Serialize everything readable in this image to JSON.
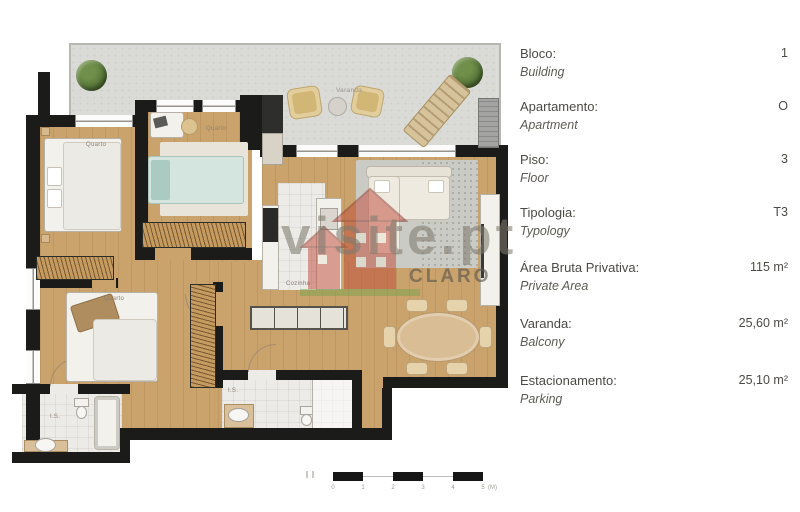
{
  "info_panel": {
    "rows": [
      {
        "label_pt": "Bloco:",
        "label_en": "Building",
        "value": "1"
      },
      {
        "label_pt": "Apartamento:",
        "label_en": "Apartment",
        "value": "O"
      },
      {
        "label_pt": "Piso:",
        "label_en": "Floor",
        "value": "3"
      },
      {
        "label_pt": "Tipologia:",
        "label_en": "Typology",
        "value": "T3"
      },
      {
        "label_pt": "Área Bruta Privativa:",
        "label_en": "Private Area",
        "value": "115 m²"
      },
      {
        "label_pt": "Varanda:",
        "label_en": "Balcony",
        "value": "25,60 m²"
      },
      {
        "label_pt": "Estacionamento:",
        "label_en": "Parking",
        "value": "25,10 m²"
      }
    ]
  },
  "floor_plan": {
    "balcony_label": "Varanda",
    "room_labels": {
      "bedroom1": "Quarto",
      "bedroom2": "Quarto",
      "bedroom3": "Quarto",
      "kitchen": "Cozinha",
      "bathroom1": "I.S.",
      "bathroom2": "I.S."
    },
    "watermark": {
      "text": "visite.pt",
      "brand": "CLARO"
    },
    "scale_bar": {
      "ticks": [
        "0",
        "1",
        "2",
        "3",
        "4",
        "5"
      ],
      "unit": "(M)"
    }
  },
  "colors": {
    "wall": "#1b1b19",
    "wood_floor": "#c9a26c",
    "terrace_floor": "#dadad6",
    "tile_floor": "#edebe8",
    "watermark_red": "#c14a39",
    "watermark_green": "#7aa24e",
    "watermark_gray": "#7d7a6e",
    "info_text": "#4b4a45"
  }
}
